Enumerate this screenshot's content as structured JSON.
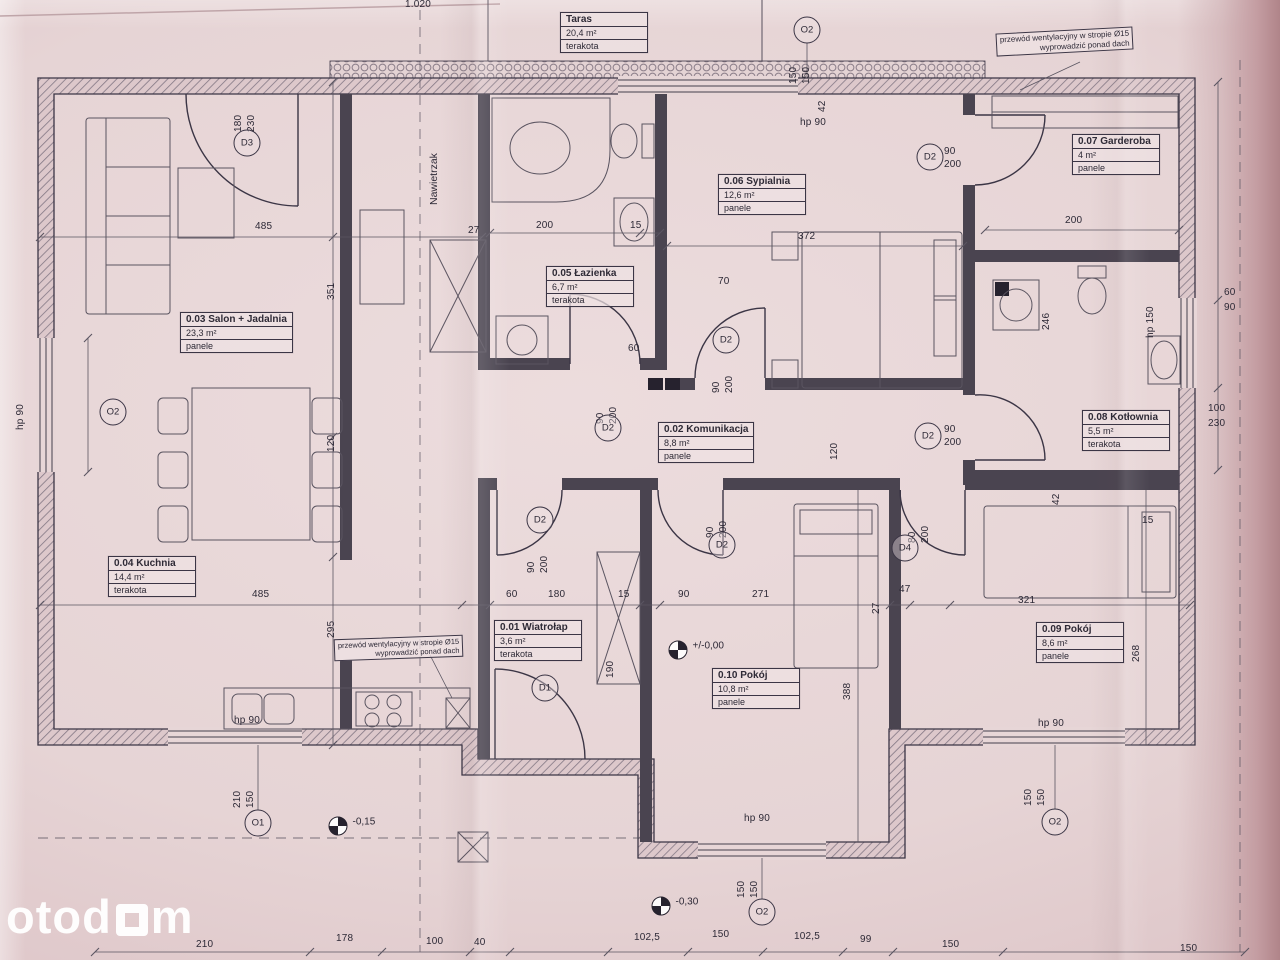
{
  "watermark": {
    "left": "otod",
    "right": "m"
  },
  "annotations": {
    "nawietrzak": "Nawietrzak"
  },
  "rooms": [
    {
      "name": "Taras",
      "area": "20,4 m²",
      "floor": "terakota",
      "x": 560,
      "y": 12
    },
    {
      "name": "0.01 Wiatrołap",
      "area": "3,6 m²",
      "floor": "terakota",
      "x": 494,
      "y": 620
    },
    {
      "name": "0.02 Komunikacja",
      "area": "8,8 m²",
      "floor": "panele",
      "x": 658,
      "y": 422
    },
    {
      "name": "0.03 Salon + Jadalnia",
      "area": "23,3 m²",
      "floor": "panele",
      "x": 180,
      "y": 312
    },
    {
      "name": "0.04 Kuchnia",
      "area": "14,4 m²",
      "floor": "terakota",
      "x": 108,
      "y": 556
    },
    {
      "name": "0.05 Łazienka",
      "area": "6,7 m²",
      "floor": "terakota",
      "x": 546,
      "y": 266
    },
    {
      "name": "0.06 Sypialnia",
      "area": "12,6 m²",
      "floor": "panele",
      "x": 718,
      "y": 174
    },
    {
      "name": "0.07 Garderoba",
      "area": "4 m²",
      "floor": "panele",
      "x": 1072,
      "y": 134
    },
    {
      "name": "0.08 Kotłownia",
      "area": "5,5 m²",
      "floor": "terakota",
      "x": 1082,
      "y": 410
    },
    {
      "name": "0.09 Pokój",
      "area": "8,6 m²",
      "floor": "panele",
      "x": 1036,
      "y": 622
    },
    {
      "name": "0.10 Pokój",
      "area": "10,8 m²",
      "floor": "panele",
      "x": 712,
      "y": 668
    }
  ],
  "markers": [
    {
      "label": "D3",
      "x": 247,
      "y": 143
    },
    {
      "label": "D1",
      "x": 545,
      "y": 688
    },
    {
      "label": "D2",
      "x": 608,
      "y": 428
    },
    {
      "label": "D2",
      "x": 726,
      "y": 340
    },
    {
      "label": "D2",
      "x": 930,
      "y": 157
    },
    {
      "label": "D2",
      "x": 928,
      "y": 436
    },
    {
      "label": "D2",
      "x": 540,
      "y": 520
    },
    {
      "label": "D2",
      "x": 722,
      "y": 545
    },
    {
      "label": "D4",
      "x": 905,
      "y": 548
    },
    {
      "label": "O2",
      "x": 113,
      "y": 412
    },
    {
      "label": "O2",
      "x": 807,
      "y": 30
    },
    {
      "label": "O1",
      "x": 258,
      "y": 823
    },
    {
      "label": "O2",
      "x": 762,
      "y": 912
    },
    {
      "label": "O2",
      "x": 1055,
      "y": 822
    }
  ],
  "levels": [
    {
      "text": "+/-0,00",
      "x": 678,
      "y": 650
    },
    {
      "text": "-0,15",
      "x": 338,
      "y": 826
    },
    {
      "text": "-0,30",
      "x": 661,
      "y": 906
    }
  ],
  "notes": [
    {
      "line1": "przewód wentylacyjny w stropie Ø15",
      "line2": "wyprowadzić ponad dach",
      "x": 334,
      "y": 637,
      "r": -2,
      "fs": 7.5
    },
    {
      "line1": "przewód wentylacyjny w stropie Ø15",
      "line2": "wyprowadzić ponad dach",
      "x": 996,
      "y": 30,
      "r": -3,
      "fs": 8
    }
  ],
  "dims": [
    {
      "t": "1.020",
      "x": 405,
      "y": 0
    },
    {
      "t": "hp 90",
      "x": 800,
      "y": 118
    },
    {
      "t": "485",
      "x": 255,
      "y": 222
    },
    {
      "t": "27",
      "x": 468,
      "y": 226
    },
    {
      "t": "200",
      "x": 536,
      "y": 221
    },
    {
      "t": "15",
      "x": 630,
      "y": 221
    },
    {
      "t": "70",
      "x": 718,
      "y": 277
    },
    {
      "t": "372",
      "x": 798,
      "y": 232
    },
    {
      "t": "200",
      "x": 1065,
      "y": 216
    },
    {
      "t": "60",
      "x": 628,
      "y": 344
    },
    {
      "t": "90",
      "x": 944,
      "y": 147
    },
    {
      "t": "200",
      "x": 944,
      "y": 160
    },
    {
      "t": "90",
      "x": 944,
      "y": 425
    },
    {
      "t": "200",
      "x": 944,
      "y": 438
    },
    {
      "t": "60",
      "x": 1224,
      "y": 288
    },
    {
      "t": "90",
      "x": 1224,
      "y": 303
    },
    {
      "t": "100",
      "x": 1208,
      "y": 404
    },
    {
      "t": "230",
      "x": 1208,
      "y": 419
    },
    {
      "t": "15",
      "x": 1142,
      "y": 516
    },
    {
      "t": "485",
      "x": 252,
      "y": 590
    },
    {
      "t": "60",
      "x": 506,
      "y": 590
    },
    {
      "t": "180",
      "x": 548,
      "y": 590
    },
    {
      "t": "15",
      "x": 618,
      "y": 590
    },
    {
      "t": "90",
      "x": 678,
      "y": 590
    },
    {
      "t": "271",
      "x": 752,
      "y": 590
    },
    {
      "t": "47",
      "x": 899,
      "y": 585
    },
    {
      "t": "321",
      "x": 1018,
      "y": 596
    },
    {
      "t": "hp 90",
      "x": 234,
      "y": 716
    },
    {
      "t": "hp 90",
      "x": 1038,
      "y": 719
    },
    {
      "t": "hp 90",
      "x": 744,
      "y": 814
    },
    {
      "t": "210",
      "x": 196,
      "y": 940
    },
    {
      "t": "178",
      "x": 336,
      "y": 934
    },
    {
      "t": "100",
      "x": 426,
      "y": 937
    },
    {
      "t": "40",
      "x": 474,
      "y": 938
    },
    {
      "t": "102,5",
      "x": 634,
      "y": 933
    },
    {
      "t": "150",
      "x": 712,
      "y": 930
    },
    {
      "t": "102,5",
      "x": 794,
      "y": 932
    },
    {
      "t": "99",
      "x": 860,
      "y": 935
    },
    {
      "t": "150",
      "x": 942,
      "y": 940
    },
    {
      "t": "150",
      "x": 1180,
      "y": 944
    },
    {
      "t": "180",
      "x": 234,
      "y": 132,
      "cls": "v"
    },
    {
      "t": "230",
      "x": 247,
      "y": 132,
      "cls": "v"
    },
    {
      "t": "42",
      "x": 818,
      "y": 112,
      "cls": "v"
    },
    {
      "t": "150",
      "x": 789,
      "y": 84,
      "cls": "v"
    },
    {
      "t": "150",
      "x": 802,
      "y": 84,
      "cls": "v"
    },
    {
      "t": "351",
      "x": 327,
      "y": 300,
      "cls": "v"
    },
    {
      "t": "120",
      "x": 327,
      "y": 452,
      "cls": "v"
    },
    {
      "t": "295",
      "x": 327,
      "y": 638,
      "cls": "v"
    },
    {
      "t": "90",
      "x": 596,
      "y": 424,
      "cls": "v"
    },
    {
      "t": "200",
      "x": 609,
      "y": 424,
      "cls": "v"
    },
    {
      "t": "90",
      "x": 712,
      "y": 393,
      "cls": "v"
    },
    {
      "t": "200",
      "x": 725,
      "y": 393,
      "cls": "v"
    },
    {
      "t": "246",
      "x": 1042,
      "y": 330,
      "cls": "v"
    },
    {
      "t": "hp 150",
      "x": 1146,
      "y": 338,
      "cls": "v"
    },
    {
      "t": "42",
      "x": 1052,
      "y": 505,
      "cls": "v"
    },
    {
      "t": "120",
      "x": 830,
      "y": 460,
      "cls": "v"
    },
    {
      "t": "90",
      "x": 527,
      "y": 573,
      "cls": "v"
    },
    {
      "t": "200",
      "x": 540,
      "y": 573,
      "cls": "v"
    },
    {
      "t": "90",
      "x": 706,
      "y": 538,
      "cls": "v"
    },
    {
      "t": "200",
      "x": 719,
      "y": 538,
      "cls": "v"
    },
    {
      "t": "80",
      "x": 908,
      "y": 543,
      "cls": "v"
    },
    {
      "t": "200",
      "x": 921,
      "y": 543,
      "cls": "v"
    },
    {
      "t": "190",
      "x": 606,
      "y": 678,
      "cls": "v"
    },
    {
      "t": "27",
      "x": 872,
      "y": 614,
      "cls": "v"
    },
    {
      "t": "388",
      "x": 843,
      "y": 700,
      "cls": "v"
    },
    {
      "t": "268",
      "x": 1132,
      "y": 662,
      "cls": "v"
    },
    {
      "t": "210",
      "x": 233,
      "y": 808,
      "cls": "v"
    },
    {
      "t": "150",
      "x": 246,
      "y": 808,
      "cls": "v"
    },
    {
      "t": "150",
      "x": 737,
      "y": 898,
      "cls": "v"
    },
    {
      "t": "150",
      "x": 750,
      "y": 898,
      "cls": "v"
    },
    {
      "t": "150",
      "x": 1024,
      "y": 806,
      "cls": "v"
    },
    {
      "t": "150",
      "x": 1037,
      "y": 806,
      "cls": "v"
    },
    {
      "t": "hp 90",
      "x": 16,
      "y": 430,
      "cls": "v"
    }
  ]
}
